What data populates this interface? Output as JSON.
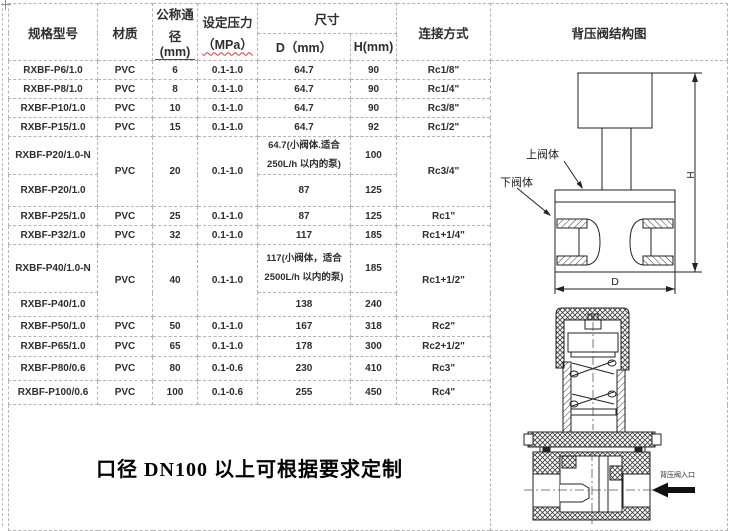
{
  "table": {
    "headers": {
      "spec_model": "规格型号",
      "material": "材质",
      "nominal_line1": "公称通",
      "nominal_line2": "径(mm)",
      "pressure_line1": "设定压力",
      "pressure_line2": "（MPa）",
      "size": "尺寸",
      "dim_d": "D（mm）",
      "dim_h": "H(mm)",
      "connection": "连接方式",
      "diagram": "背压阀结构图"
    },
    "rows": [
      [
        {
          "t": "RXBF-P6/1.0"
        },
        {
          "t": "PVC"
        },
        {
          "t": "6"
        },
        {
          "t": "0.1-1.0"
        },
        {
          "t": "64.7"
        },
        {
          "t": "90"
        },
        {
          "t": "Rc1/8\""
        }
      ],
      [
        {
          "t": "RXBF-P8/1.0"
        },
        {
          "t": "PVC"
        },
        {
          "t": "8"
        },
        {
          "t": "0.1-1.0"
        },
        {
          "t": "64.7"
        },
        {
          "t": "90"
        },
        {
          "t": "Rc1/4\""
        }
      ],
      [
        {
          "t": "RXBF-P10/1.0"
        },
        {
          "t": "PVC"
        },
        {
          "t": "10"
        },
        {
          "t": "0.1-1.0"
        },
        {
          "t": "64.7"
        },
        {
          "t": "90"
        },
        {
          "t": "Rc3/8\""
        }
      ],
      [
        {
          "t": "RXBF-P15/1.0"
        },
        {
          "t": "PVC"
        },
        {
          "t": "15"
        },
        {
          "t": "0.1-1.0"
        },
        {
          "t": "64.7"
        },
        {
          "t": "92"
        },
        {
          "t": "Rc1/2\""
        }
      ],
      [
        {
          "t": "RXBF-P20/1.0-N"
        },
        {
          "t": "PVC",
          "rs": 2
        },
        {
          "t": "20",
          "rs": 2
        },
        {
          "t": "0.1-1.0",
          "rs": 2
        },
        {
          "t": "64.7(小阀体.适合 250L/h 以内的泵)",
          "cls": "dsmall"
        },
        {
          "t": "100"
        },
        {
          "t": "Rc3/4\"",
          "rs": 2
        }
      ],
      [
        {
          "t": "RXBF-P20/1.0"
        },
        {
          "t": "87"
        },
        {
          "t": "125"
        }
      ],
      [
        {
          "t": "RXBF-P25/1.0"
        },
        {
          "t": "PVC"
        },
        {
          "t": "25"
        },
        {
          "t": "0.1-1.0"
        },
        {
          "t": "87"
        },
        {
          "t": "125"
        },
        {
          "t": "Rc1\""
        }
      ],
      [
        {
          "t": "RXBF-P32/1.0"
        },
        {
          "t": "PVC"
        },
        {
          "t": "32"
        },
        {
          "t": "0.1-1.0"
        },
        {
          "t": "117"
        },
        {
          "t": "185"
        },
        {
          "t": "Rc1+1/4\""
        }
      ],
      [
        {
          "t": "RXBF-P40/1.0-N"
        },
        {
          "t": "PVC",
          "rs": 2
        },
        {
          "t": "40",
          "rs": 2
        },
        {
          "t": "0.1-1.0",
          "rs": 2
        },
        {
          "t": "117(小阀体，适合 2500L/h 以内的泵)",
          "cls": "dsmall"
        },
        {
          "t": "185"
        },
        {
          "t": "Rc1+1/2\"",
          "rs": 2
        }
      ],
      [
        {
          "t": "RXBF-P40/1.0"
        },
        {
          "t": "138"
        },
        {
          "t": "240"
        }
      ],
      [
        {
          "t": "RXBF-P50/1.0"
        },
        {
          "t": "PVC"
        },
        {
          "t": "50"
        },
        {
          "t": "0.1-1.0"
        },
        {
          "t": "167"
        },
        {
          "t": "318"
        },
        {
          "t": "Rc2\""
        }
      ],
      [
        {
          "t": "RXBF-P65/1.0"
        },
        {
          "t": "PVC"
        },
        {
          "t": "65"
        },
        {
          "t": "0.1-1.0"
        },
        {
          "t": "178"
        },
        {
          "t": "300"
        },
        {
          "t": "Rc2+1/2\""
        }
      ],
      [
        {
          "t": "RXBF-P80/0.6"
        },
        {
          "t": "PVC"
        },
        {
          "t": "80"
        },
        {
          "t": "0.1-0.6"
        },
        {
          "t": "230"
        },
        {
          "t": "410"
        },
        {
          "t": "Rc3\""
        }
      ],
      [
        {
          "t": "RXBF-P100/0.6"
        },
        {
          "t": "PVC"
        },
        {
          "t": "100"
        },
        {
          "t": "0.1-0.6"
        },
        {
          "t": "255"
        },
        {
          "t": "450"
        },
        {
          "t": "Rc4\""
        }
      ]
    ]
  },
  "note": "口径 DN100 以上可根据要求定制",
  "diagram": {
    "labels": {
      "upper_body": "上阀体",
      "lower_body": "下阀体",
      "dim_h": "H",
      "dim_d": "D",
      "inlet": "背压阀入口"
    },
    "colors": {
      "line": "#222222",
      "border_dash": "#b4b4b4",
      "squiggle": "#e03030",
      "inlet_arrow": "#111111"
    }
  }
}
